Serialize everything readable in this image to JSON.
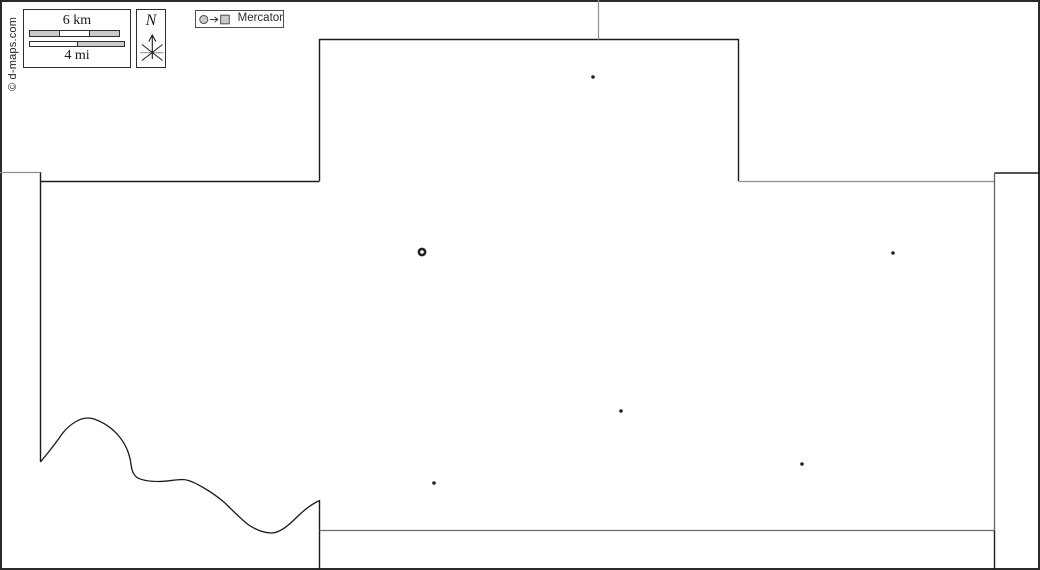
{
  "copyright": {
    "text": "© d-maps.com"
  },
  "scale_bar": {
    "km_label": "6 km",
    "mi_label": "4 mi"
  },
  "compass": {
    "label": "N"
  },
  "projection_legend": {
    "label": "Mercator"
  },
  "colors": {
    "background": "#ffffff",
    "frame": "#2a2a2a",
    "main": "#1b1b1b",
    "neighbor": "#909090",
    "neighbor_dark": "#6b6b6b",
    "marker": "#222222",
    "symbol_fill": "#cacaca",
    "symbol_stroke": "#4d4d4d"
  },
  "map": {
    "outlines": [
      {
        "name": "image-frame",
        "color": "frame",
        "width": 2,
        "path": "M 1,1 H 1039 V 569 H 1 Z"
      },
      {
        "name": "north-protrusion",
        "color": "main",
        "width": 1.4,
        "path": "M 319.5,181 V 39.5 H 738.5 V 181"
      },
      {
        "name": "northwest-boundary",
        "color": "main",
        "width": 1.4,
        "path": "M 40.5,181.5 H 319.5"
      },
      {
        "name": "west-boundary",
        "color": "main",
        "width": 1.4,
        "path": "M 40.5,172 V 462"
      },
      {
        "name": "river-boundary",
        "color": "main",
        "width": 1.3,
        "path": "M 40.5,462 C 46,455 54,446 62,434 C 65,430 70,425 76,421.5 C 82,418 88,417 94,419 C 104,422.5 113,428.5 120,437.5 C 126,445 129,453 130.5,461 C 131.5,469 132.5,474 137,477.5 C 143,481 151,481.5 159,481.5 C 167,481.5 176,479.5 183,479.5 C 190,480 197,484 204,488 C 211,492 218,497 225,503 C 232,510 240,518 248,524.5 C 256,530 264,533 272,533 C 280,532.5 288,526 297,517 C 306,508 313,503.5 319.5,500.5"
      },
      {
        "name": "southwest-vertical",
        "color": "main",
        "width": 1.4,
        "path": "M 319.5,500 V 569"
      },
      {
        "name": "southeast-vertical",
        "color": "main",
        "width": 1.4,
        "path": "M 994.5,530 V 569"
      },
      {
        "name": "northeast-link",
        "color": "main",
        "width": 1.4,
        "path": "M 994.5,173 H 1040"
      },
      {
        "name": "neighbor-north",
        "color": "neighbor",
        "width": 1.2,
        "path": "M 598.5,0 V 39.5"
      },
      {
        "name": "neighbor-west",
        "color": "neighbor",
        "width": 1.2,
        "path": "M 0,172.5 H 40.5"
      },
      {
        "name": "neighbor-step-east",
        "color": "neighbor",
        "width": 1.2,
        "path": "M 738.5,181.5 H 994.5"
      },
      {
        "name": "east-boundary",
        "color": "neighbor_dark",
        "width": 1.4,
        "path": "M 994.5,173 V 530.5"
      },
      {
        "name": "south-boundary",
        "color": "neighbor_dark",
        "width": 1.2,
        "path": "M 319.5,530.5 H 994.5"
      }
    ],
    "markers": {
      "towns": [
        {
          "x": 593,
          "y": 77
        },
        {
          "x": 893,
          "y": 253
        },
        {
          "x": 621,
          "y": 411
        },
        {
          "x": 434,
          "y": 483
        },
        {
          "x": 802,
          "y": 464
        }
      ],
      "county_seat": {
        "x": 422,
        "y": 252
      }
    }
  }
}
